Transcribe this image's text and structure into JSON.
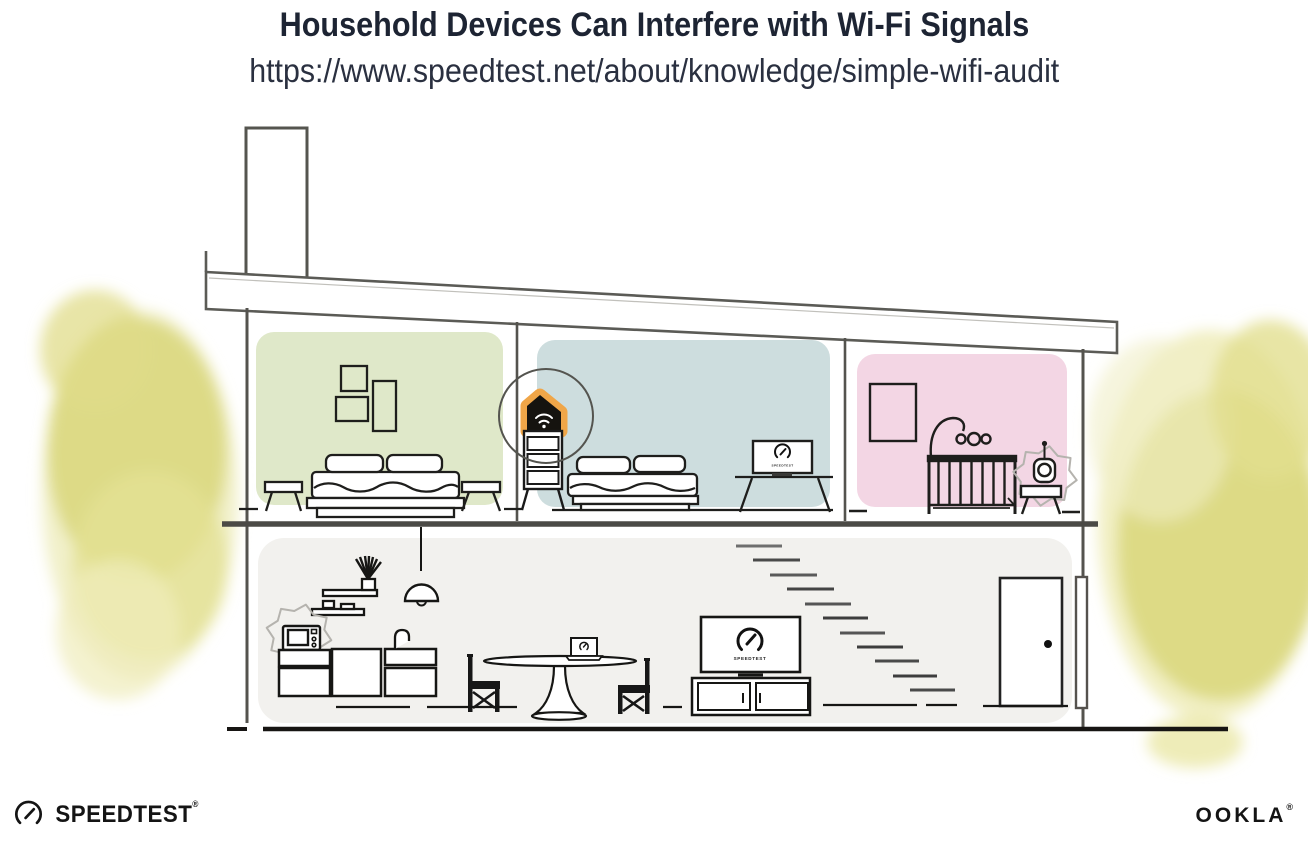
{
  "header": {
    "title": "Household Devices Can Interfere with Wi-Fi Signals",
    "url": "https://www.speedtest.net/about/knowledge/simple-wifi-audit"
  },
  "branding": {
    "speedtest": "SPEEDTEST",
    "ookla": "OOKLA",
    "trademark": "®"
  },
  "screens": {
    "label": "SPEEDTEST"
  },
  "illustration": {
    "rooms": [
      {
        "name": "bedroom-1",
        "color": "#dfe8c9"
      },
      {
        "name": "office-bedroom",
        "color": "#cdddde"
      },
      {
        "name": "nursery",
        "color": "#f3d6e4"
      },
      {
        "name": "living-kitchen",
        "color": "#f2f1ee"
      }
    ],
    "interference_sources": [
      "wifi-router",
      "microwave-oven",
      "baby-monitor"
    ],
    "accent_orange": "#f0a648",
    "tree_color": "#dcd87e",
    "cloud_gray": "#b5b3ae"
  }
}
